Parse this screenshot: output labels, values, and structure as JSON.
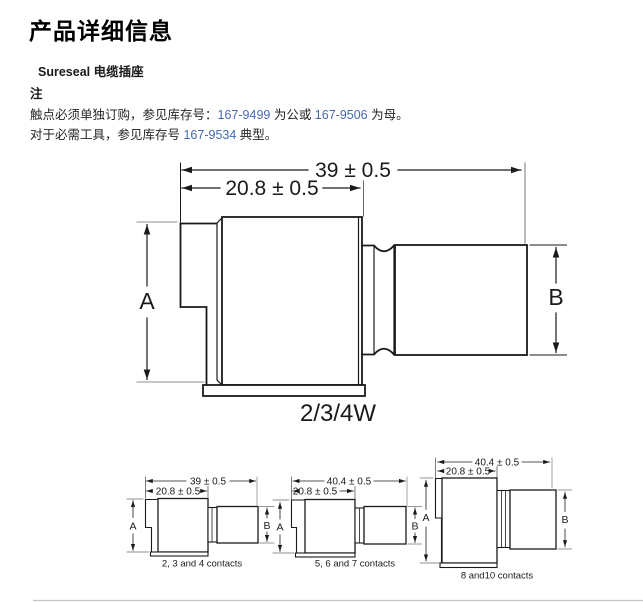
{
  "header": {
    "page_title": "产品详细信息",
    "product_name": "Sureseal 电缆插座",
    "note_label": "注",
    "note1_text": "触点必须单独订购，参见库存号：",
    "note1_link1": "167-9499",
    "note1_mid": " 为公或 ",
    "note1_link2": "167-9506",
    "note1_end": " 为母。",
    "note2_text": "对于必需工具，参见库存号 ",
    "note2_link": "167-9534",
    "note2_end": " 典型。"
  },
  "colors": {
    "link_blue": "#4569b0",
    "drawing_line": "#1a1a1a",
    "extension_grey": "#8f8f8f",
    "divider_grey": "#c4c4c4"
  },
  "diagrams": {
    "main": {
      "dim_overall": "39 ± 0.5",
      "dim_inner": "20.8 ± 0.5",
      "label_a": "A",
      "label_b": "B",
      "caption": "2/3/4W"
    },
    "small": [
      {
        "dim_overall": "39 ± 0.5",
        "dim_inner": "20.8 ± 0.5",
        "label_a": "A",
        "label_b": "B",
        "caption": "2, 3 and 4 contacts"
      },
      {
        "dim_overall": "40.4 ± 0.5",
        "dim_inner": "20.8 ± 0.5",
        "label_a": "A",
        "label_b": "B",
        "caption": "5, 6 and 7 contacts"
      },
      {
        "dim_overall": "40.4 ± 0.5",
        "dim_inner": "20.8 ± 0.5",
        "label_a": "A",
        "label_b": "B",
        "caption": "8 and10 contacts"
      }
    ]
  }
}
